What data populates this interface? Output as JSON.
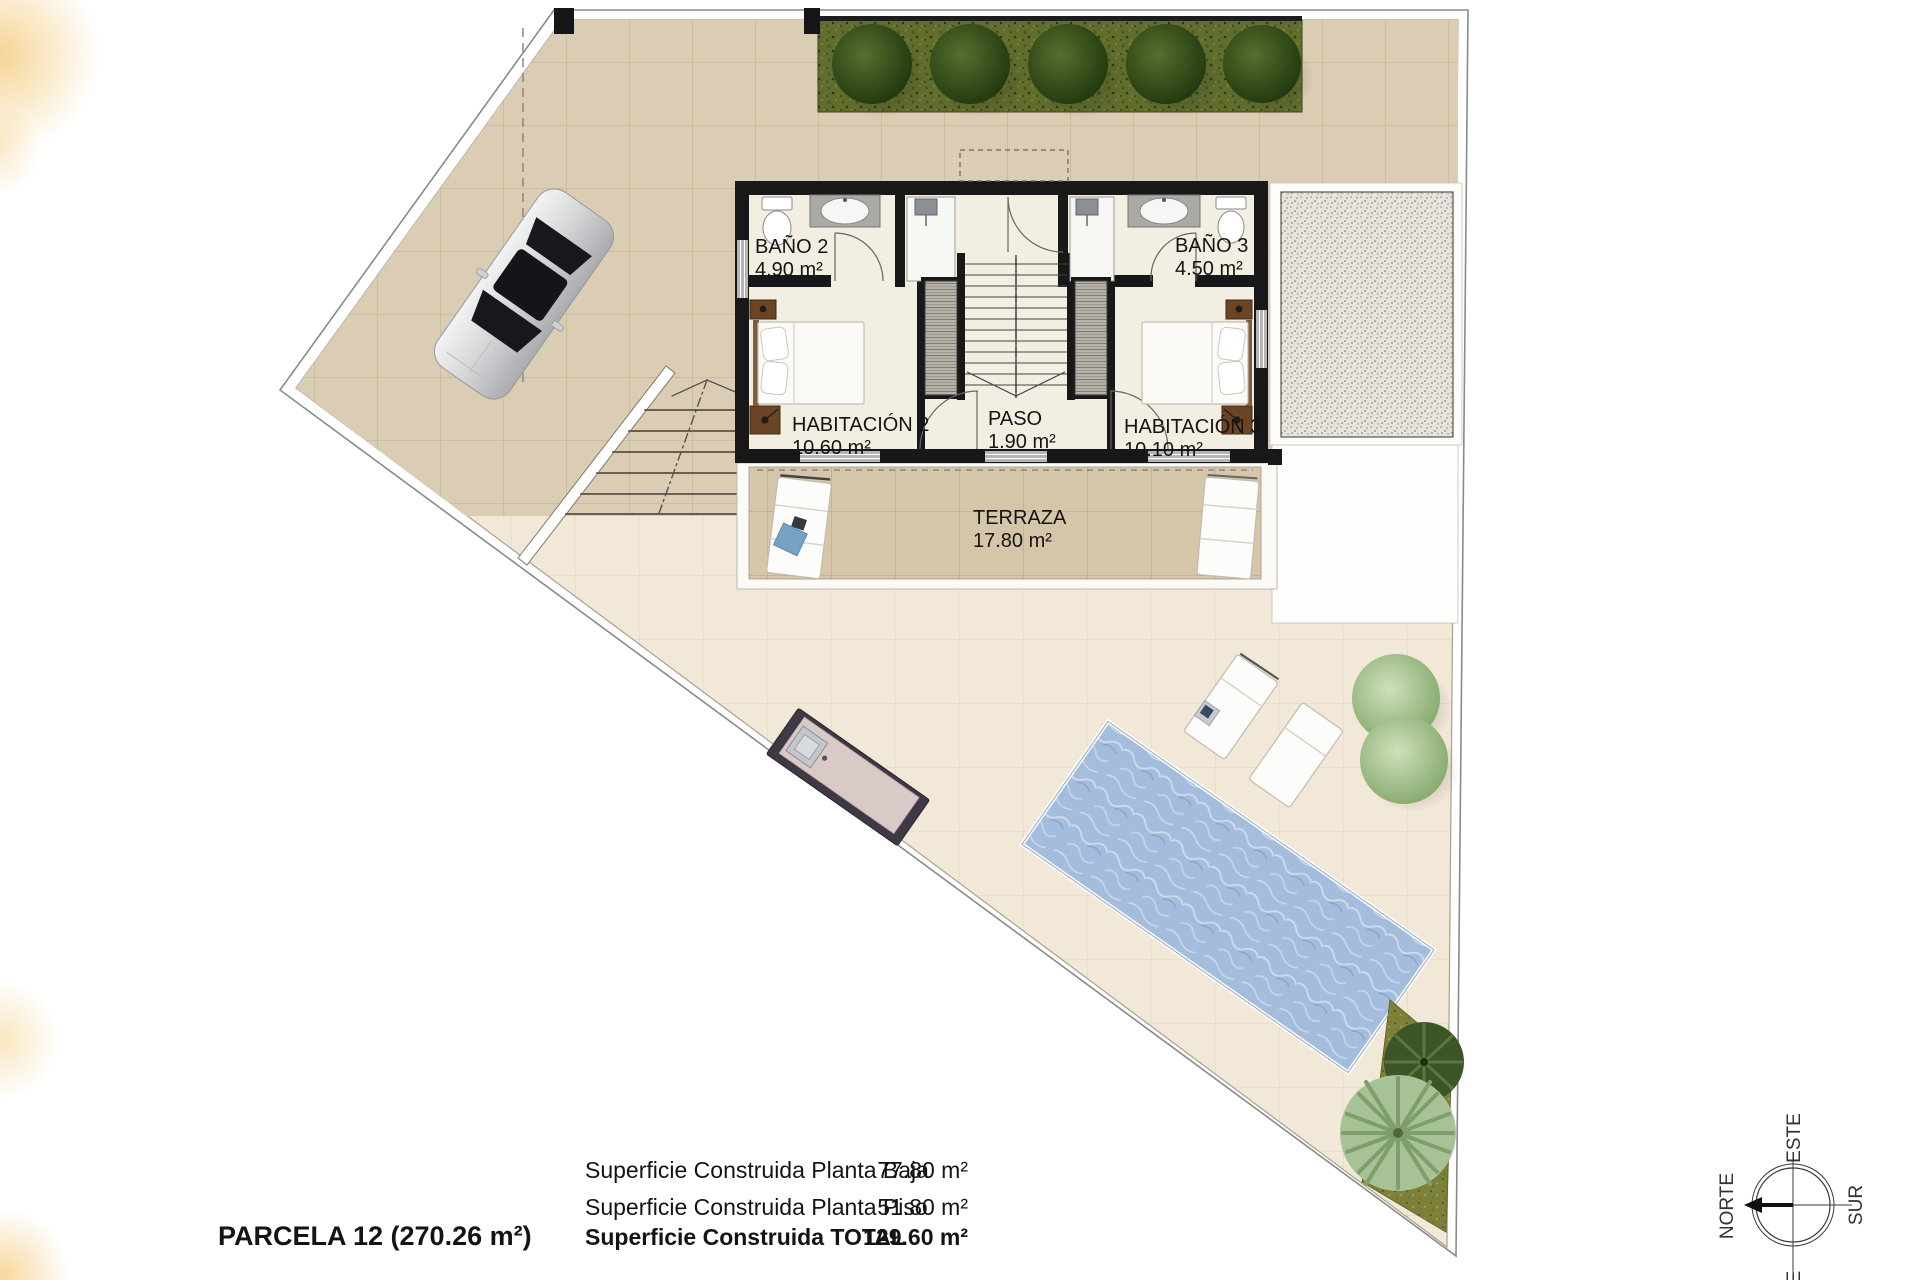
{
  "rooms": {
    "bano2": {
      "name": "BAÑO 2",
      "area": "4.90 m²"
    },
    "bano3": {
      "name": "BAÑO 3",
      "area": "4.50 m²"
    },
    "hab2": {
      "name": "HABITACIÓN 2",
      "area": "10.60 m²"
    },
    "paso": {
      "name": "PASO",
      "area": "1.90 m²"
    },
    "hab3": {
      "name": "HABITACIÓN 3",
      "area": "10.10 m²"
    },
    "terraza": {
      "name": "TERRAZA",
      "area": "17.80 m²"
    }
  },
  "summary": {
    "parcela": "PARCELA 12 (270.26 m²)",
    "rows": [
      {
        "label": "Superficie Construida Planta Baja",
        "value": "77.80 m²"
      },
      {
        "label": "Superficie Construida Planta Piso",
        "value": "51.80 m²"
      },
      {
        "label": "Superficie Construida TOTAL",
        "value": "129.60 m²"
      }
    ]
  },
  "compass": {
    "north": "NORTE",
    "south": "SUR",
    "east": "ESTE",
    "west": "OESTE"
  },
  "colors": {
    "paper": "#ffffff",
    "tile_light": "#f1e8d8",
    "tile_dark": "#dbcdb3",
    "terrace_tile": "#d5c6a9",
    "grass": "#606d2c",
    "pool_water": "#a5bddd",
    "wall": "#181818",
    "gravel": "#e7e3dd",
    "accent_gold": "#eeb13c"
  }
}
